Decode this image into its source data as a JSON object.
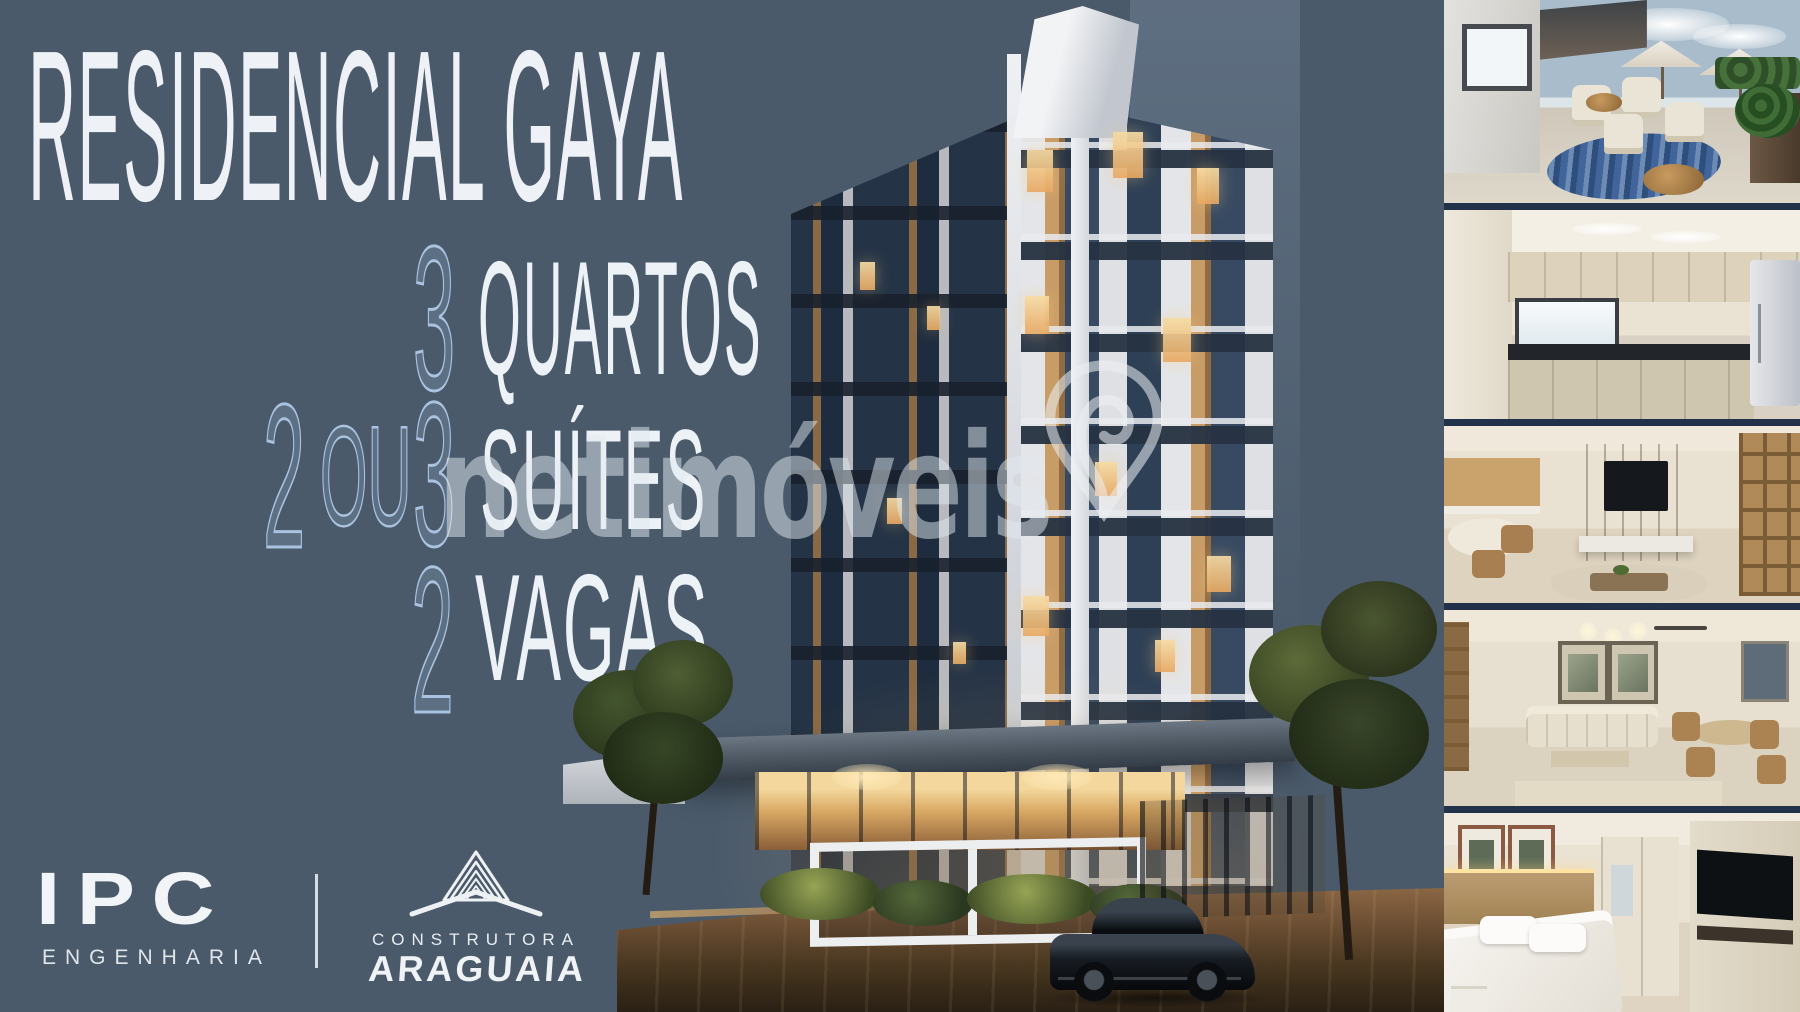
{
  "meta": {
    "width": 1800,
    "height": 1012
  },
  "colors": {
    "background": "#4a5a6b",
    "outline_text": "#a9c3e0",
    "solid_text": "#edf2f7",
    "watermark": "rgba(226,233,240,0.50)",
    "photo_border": "#22324a",
    "dusk_light": "#f2c47c"
  },
  "headline": {
    "title": "RESIDENCIAL GAYA"
  },
  "features": {
    "line1": {
      "qty": "3",
      "label": "QUARTOS"
    },
    "line2": {
      "qty_a": "2",
      "conjunction": "OU",
      "qty_b": "3",
      "label": "SUÍTES"
    },
    "line3": {
      "qty": "2",
      "label": "VAGAS"
    }
  },
  "watermark": {
    "text": "netimóveis",
    "icon": "map-pin-icon"
  },
  "footer_logos": {
    "ipc": {
      "acronym": "IPC",
      "subtitle": "ENGENHARIA"
    },
    "araguaia": {
      "line1": "CONSTRUTORA",
      "line2": "ARAGUAIA",
      "icon": "pyramid-roof-icon"
    }
  },
  "building": {
    "alt": "residential tower render at dusk with entrance canopy, trees and black sports car"
  },
  "gallery": {
    "photos": [
      {
        "alt": "rooftop terrace with umbrellas, lounge chairs, blue rug and planters"
      },
      {
        "alt": "kitchen with cream cabinets, dark countertop and bright window"
      },
      {
        "alt": "open living room with wood TV panel, bookshelf and dining table"
      },
      {
        "alt": "living and dining room with beige sofa, framed art and table set"
      },
      {
        "alt": "bedroom with white bed, wood headboard wall and TV panel"
      }
    ]
  }
}
